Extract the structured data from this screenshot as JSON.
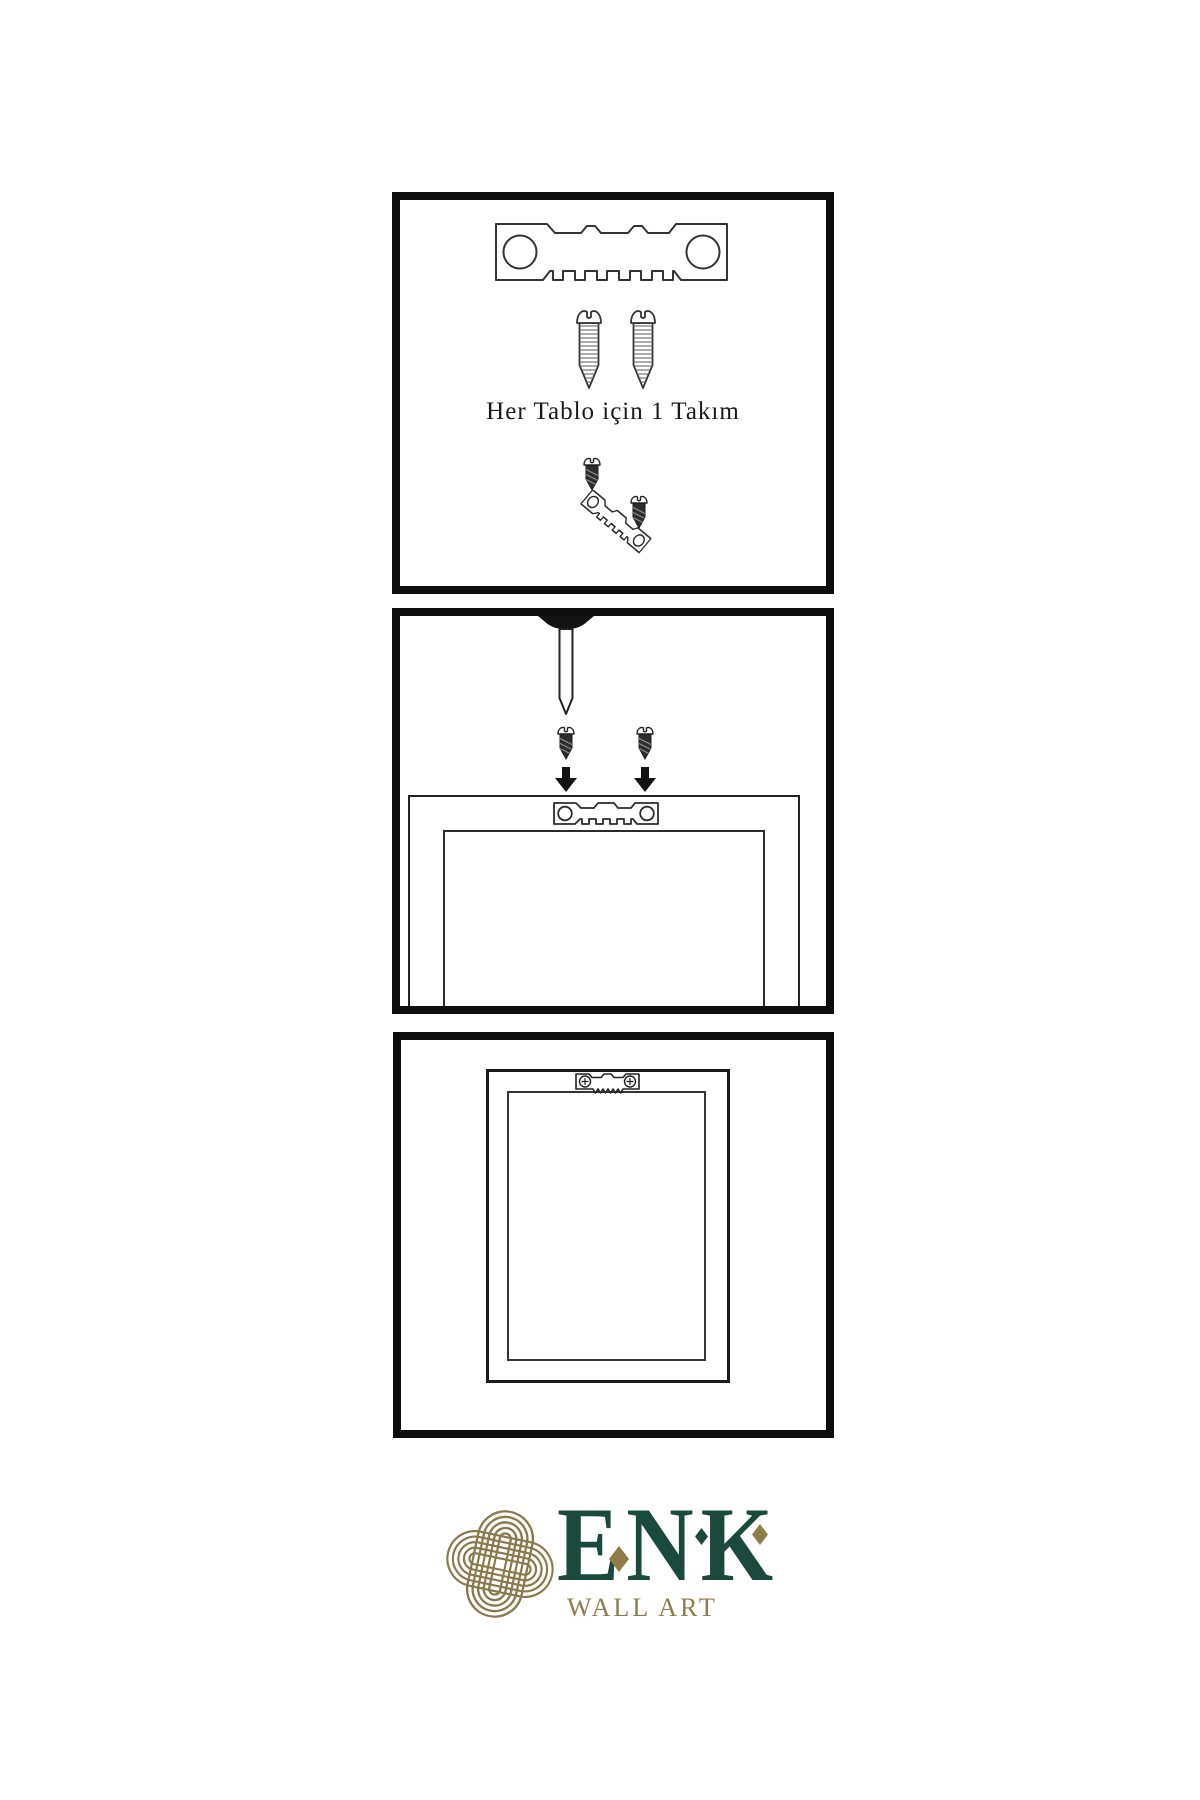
{
  "document_type": "wall-art hanging instruction sheet",
  "colors": {
    "background": "#ffffff",
    "panel_border": "#0d0d0d",
    "line_art": "#333333",
    "dark_hardware": "#2e2e2e",
    "brand_green": "#1b4a3d",
    "brand_gold": "#8a7949",
    "subtitle_gold": "#8d7c4e"
  },
  "instructions": {
    "step1": {
      "caption": "Her Tablo için 1 Takım",
      "illustrations": [
        "sawtooth-hanger",
        "screw",
        "screw",
        "dark-screw",
        "angled-sawtooth-hanger",
        "dark-screw"
      ]
    },
    "step2": {
      "illustrations": [
        "wall-nail",
        "dark-screw",
        "dark-screw",
        "down-arrow",
        "down-arrow",
        "frame-back-top",
        "sawtooth-hanger-on-frame"
      ]
    },
    "step3": {
      "illustrations": [
        "frame-back",
        "mounted-sawtooth-hanger-with-screws"
      ]
    }
  },
  "logo": {
    "brand": "ENK",
    "subtitle": "WALL ART",
    "mark": "interlaced-knot"
  }
}
